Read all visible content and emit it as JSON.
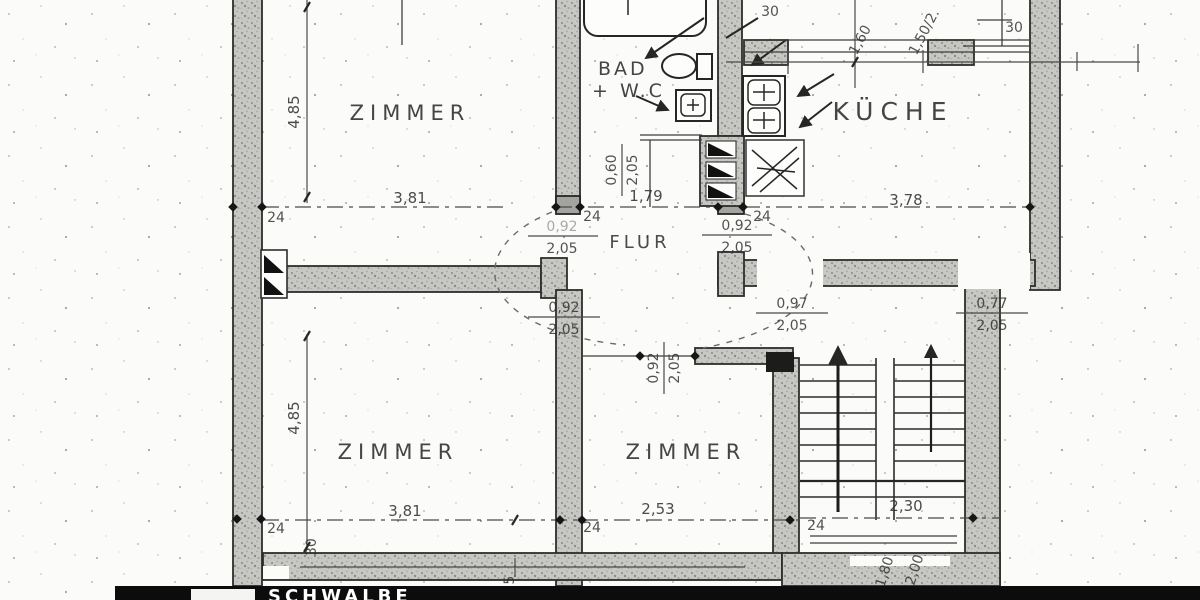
{
  "plan": {
    "rooms": {
      "zimmer": "ZIMMER",
      "kueche": "KÜCHE",
      "bad": "BAD",
      "bad_wc": "+ W.C",
      "flur": "FLUR"
    },
    "dims": {
      "d485": "4,85",
      "d381": "3,81",
      "d179": "1,79",
      "d378": "3,78",
      "d253": "2,53",
      "d230": "2,30",
      "d24": "24",
      "d30": "30",
      "d160": "1,60",
      "d150": "1,50/2.",
      "d180": "1,80",
      "d200": "2,00",
      "d35": "3,5"
    },
    "doors": {
      "w092": "0,92",
      "w097": "0,97",
      "w077": "0,77",
      "w060": "0,60",
      "h205": "2,05"
    }
  },
  "footer": {
    "logo_text": "SCHWALBE"
  }
}
